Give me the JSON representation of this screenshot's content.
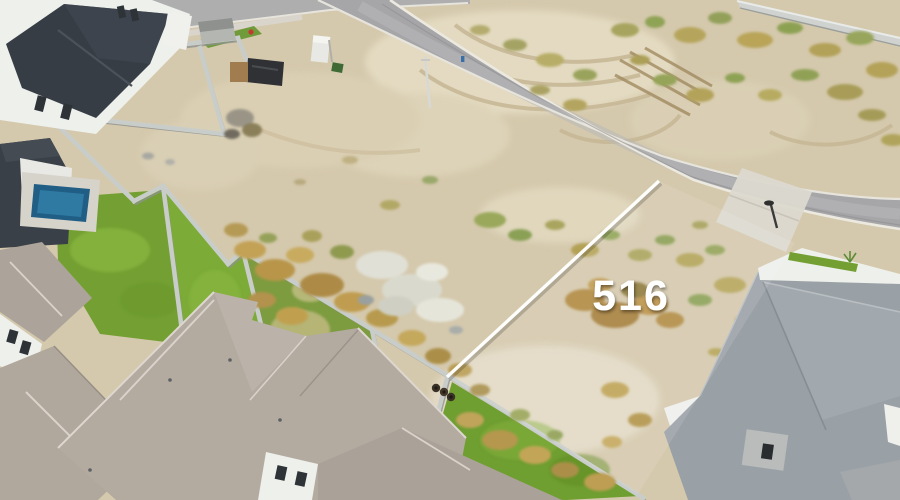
{
  "meta": {
    "description": "Aerial drone photograph of a vacant desert residential lot marked 516, bordered by a curved asphalt road, scrub vegetation, concrete block walls, green lawns and suburban homes with gray shingle roofs, a backyard pool at left and a white-walled home at lower right."
  },
  "overlay": {
    "lot_number": "516",
    "label_color": "#ffffff",
    "boundary_line_color": "#ffffff"
  },
  "palette": {
    "dirt": "#d5c9ad",
    "dirt_light": "#e3dac1",
    "asphalt": "#a6a6a8",
    "curb": "#e6e4dc",
    "concrete_apron": "#dcd8cf",
    "lawn_green": "#74a033",
    "lawn_bright": "#8fbf44",
    "scrub_tan": "#bda05a",
    "scrub_olive": "#8fa355",
    "scrub_brown": "#ad8a44",
    "block_wall": "#c9cdca",
    "roof_warm_gray": "#b0a79d",
    "roof_dark_charcoal": "#373d45",
    "roof_cool_gray": "#9aa1a6",
    "house_white": "#eef0ec",
    "pool_blue": "#205e85",
    "mud_white": "#dfdfd5"
  }
}
